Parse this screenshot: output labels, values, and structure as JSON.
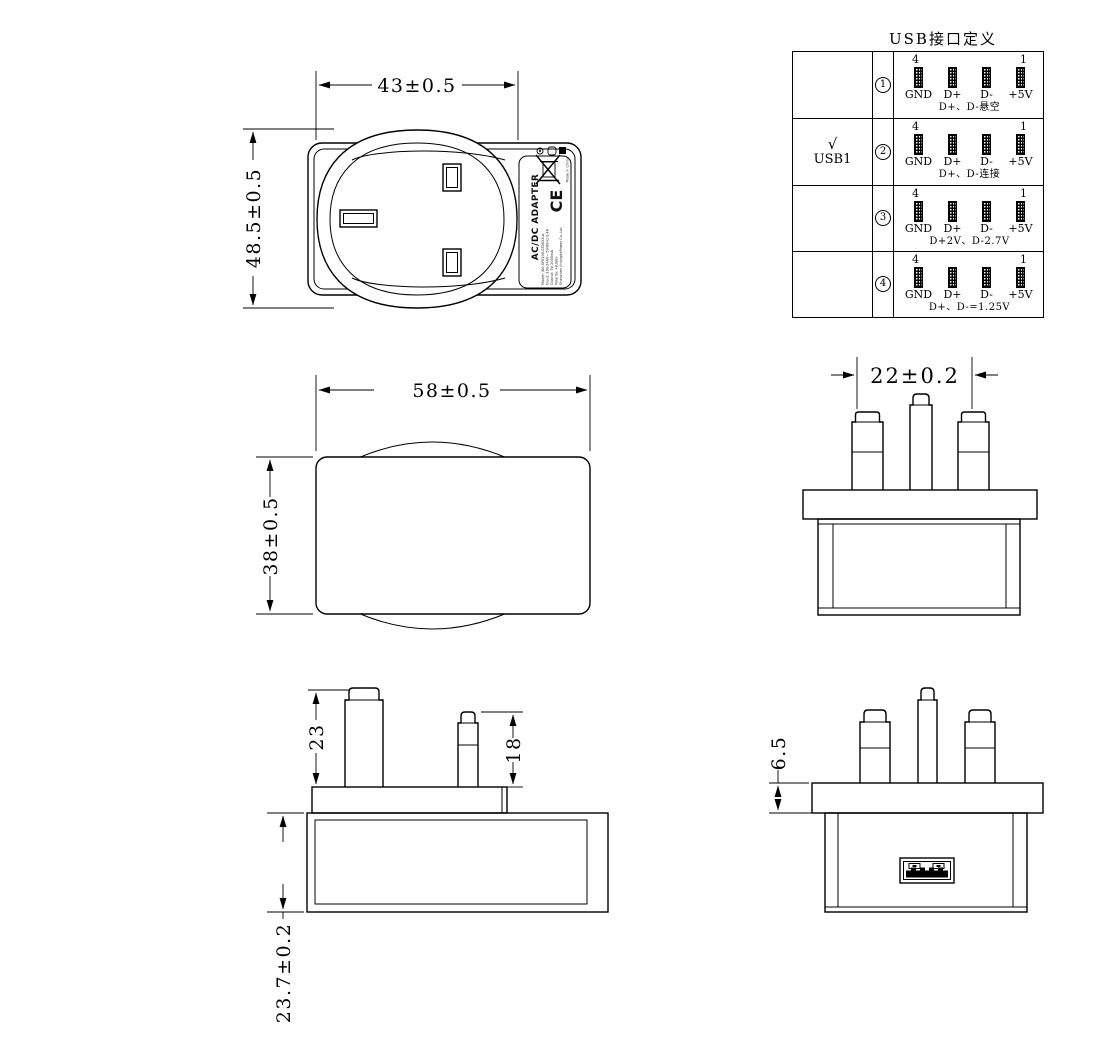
{
  "colors": {
    "line": "#000000",
    "background": "#ffffff"
  },
  "usb_table": {
    "title": "USB接口定义",
    "pin_numbers": {
      "first": "4",
      "last": "1"
    },
    "rows": [
      {
        "option_check": "",
        "option_label": "",
        "circle_num": "1",
        "pins": [
          "GND",
          "D+",
          "D-",
          "+5V"
        ],
        "note": "D+、D-悬空"
      },
      {
        "option_check": "√",
        "option_label": "USB1",
        "circle_num": "2",
        "pins": [
          "GND",
          "D+",
          "D-",
          "+5V"
        ],
        "note": "D+、D-连接"
      },
      {
        "option_check": "",
        "option_label": "",
        "circle_num": "3",
        "pins": [
          "GND",
          "D+",
          "D-",
          "+5V"
        ],
        "note": "D+2V、D-2.7V"
      },
      {
        "option_check": "",
        "option_label": "",
        "circle_num": "4",
        "pins": [
          "GND",
          "D+",
          "D-",
          "+5V"
        ],
        "note": "D+、D-=1.25V"
      }
    ]
  },
  "drawing": {
    "front_view": {
      "dim_width": "43±0.5",
      "dim_height": "48.5±0.5"
    },
    "top_view": {
      "dim_width": "58±0.5",
      "dim_height": "38±0.5"
    },
    "pin_face_view": {
      "dim_pin_spacing": "22±0.2"
    },
    "side_view": {
      "dim_earth_pin": "23",
      "dim_line_pin": "18",
      "dim_body_thickness": "23.7±0.2"
    },
    "usb_face_view": {
      "dim_flange": "6.5"
    },
    "label": {
      "product": "AC/DC ADAPTER",
      "ce_mark": "CE",
      "made_in": "Made in China",
      "line1": "Model: JB0-SP0100-0500XX-A",
      "line2": "Input: 100-240V~ 50/60Hz 0.4A",
      "line3": "Output: 5V 2000mA",
      "line4": "Polarity: +(USB)-",
      "line5": "Shenzhen JihongdePower Co.,Ltd"
    }
  }
}
